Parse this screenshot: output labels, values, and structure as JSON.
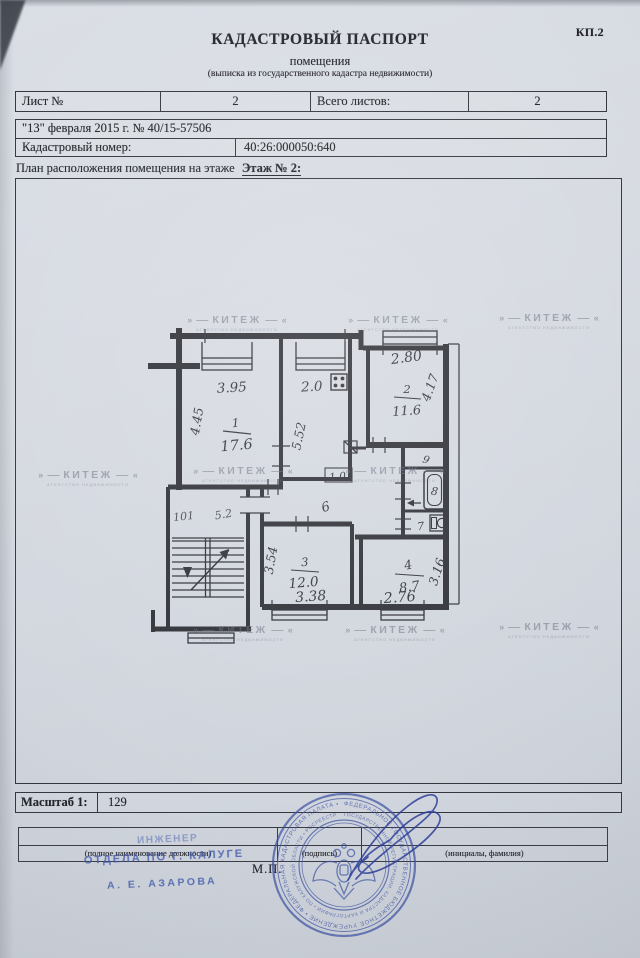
{
  "doc_code": "КП.2",
  "header": {
    "title": "КАДАСТРОВЫЙ ПАСПОРТ",
    "subtitle": "помещения",
    "note": "(выписка из государственного кадастра недвижимости)"
  },
  "meta": {
    "sheet_label": "Лист №",
    "sheet_value": "2",
    "total_label": "Всего листов:",
    "total_value": "2",
    "date_line": "\"13\" февраля 2015 г. № 40/15-57506",
    "cadastral_label": "Кадастровый номер:",
    "cadastral_value": "40:26:000050:640"
  },
  "plan": {
    "caption": "План расположения помещения на этаже",
    "caption_floor": "Этаж № 2:",
    "rooms": {
      "r1": {
        "num": "1",
        "area": "17.6"
      },
      "r2": {
        "num": "2",
        "area": "11.6"
      },
      "r3": {
        "num": "3",
        "area": "12.0"
      },
      "r4": {
        "num": "4",
        "area": "8.7"
      },
      "corridor": "6",
      "closet": "9",
      "bath": "8",
      "wc": "7"
    },
    "dims": {
      "r1_top": "3.95",
      "r1_left": "4.45",
      "kitchen_top": "2.0",
      "kitchen_left": "5.52",
      "r2_top": "2.80",
      "r2_right": "4.17",
      "door_width": "1.0",
      "r3_left": "3.54",
      "r3_bottom": "3.38",
      "r4_bottom": "2.76",
      "r4_right": "3.16"
    },
    "pencil_marks": {
      "a": "101",
      "b": "5.2"
    }
  },
  "scale": {
    "label": "Масштаб 1:",
    "value": "129"
  },
  "signature": {
    "position_caption": "(полное наименование должности)",
    "sign_caption": "(подпись)",
    "name_caption": "(инициалы, фамилия)",
    "seal_mark": "М.П.",
    "stamp_position": "ИНЖЕНЕР",
    "stamp_department": "ОТДЕЛА ПО Г. КАЛУГЕ",
    "stamp_name": "А. Е. АЗАРОВА"
  },
  "round_stamp": {
    "outer_text": "ФЕДЕРАЛЬНОЕ ГОСУДАРСТВЕННОЕ БЮДЖЕТНОЕ УЧРЕЖДЕНИЕ • ФЕДЕРАЛЬНАЯ КАДАСТРОВАЯ ПАЛАТА •",
    "inner_text": "ГОСУДАРСТВЕННОЙ РЕГИСТРАЦИИ, КАДАСТРА И КАРТОГРАФИИ • ПО КАЛУЖСКОЙ ОБЛАСТИ • РОСРЕЕСТР"
  },
  "watermark": {
    "text": "КИТЕЖ",
    "subtext": "АГЕНТСТВО НЕДВИЖИМОСТИ",
    "positions": [
      {
        "x": 237,
        "y": 323
      },
      {
        "x": 398,
        "y": 323
      },
      {
        "x": 549,
        "y": 321
      },
      {
        "x": 88,
        "y": 478
      },
      {
        "x": 243,
        "y": 474
      },
      {
        "x": 395,
        "y": 474
      },
      {
        "x": 243,
        "y": 633
      },
      {
        "x": 395,
        "y": 633
      },
      {
        "x": 549,
        "y": 630
      }
    ]
  },
  "colors": {
    "ink": "#33343c",
    "stamp_blue": "#3c55ac",
    "pencil": "#9ba3b1",
    "paper": "#d5d9e0"
  }
}
